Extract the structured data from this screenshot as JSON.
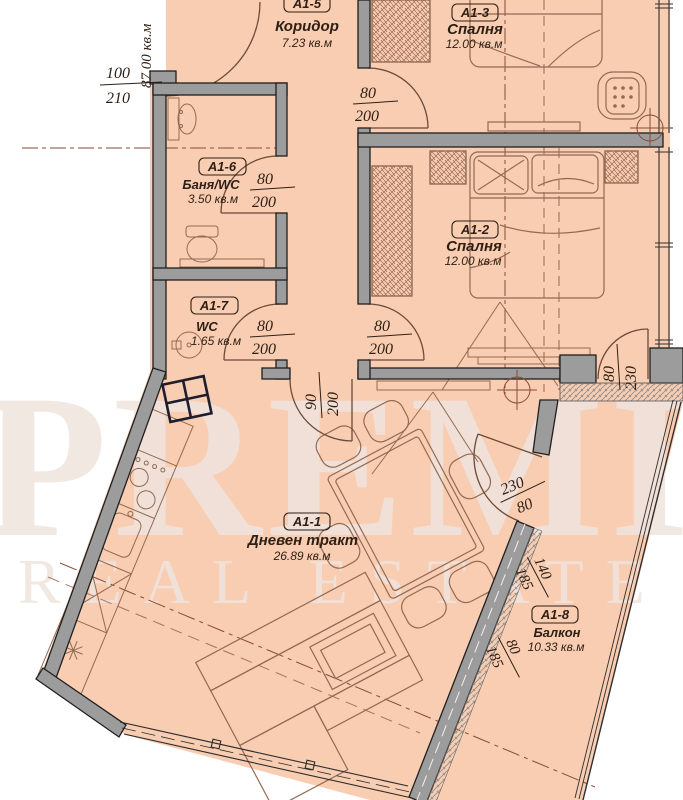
{
  "watermark": {
    "brand": "PREMIER",
    "tagline": "REAL ESTATE"
  },
  "total_area_side_label": "87.00 кв.м",
  "rooms": {
    "corridor": {
      "code": "А1-5",
      "name": "Коридор",
      "area": "7.23 кв.м"
    },
    "bedroom3": {
      "code": "А1-3",
      "name": "Спалня",
      "area": "12.00 кв.м"
    },
    "bathroom": {
      "code": "А1-6",
      "name": "Баня/WC",
      "area": "3.50 кв.м"
    },
    "wc": {
      "code": "А1-7",
      "name": "WC",
      "area": "1.65 кв.м"
    },
    "bedroom2": {
      "code": "А1-2",
      "name": "Спалня",
      "area": "12.00 кв.м"
    },
    "living": {
      "code": "А1-1",
      "name": "Дневен тракт",
      "area": "26.89 кв.м"
    },
    "balcony": {
      "code": "А1-8",
      "name": "Балкон",
      "area": "10.33 кв.м"
    }
  },
  "dims": {
    "entrance": {
      "w": "100",
      "h": "210"
    },
    "bedroom3_door": {
      "w": "80",
      "h": "200"
    },
    "bath_door": {
      "w": "80",
      "h": "200"
    },
    "wc_door": {
      "w": "80",
      "h": "200"
    },
    "bedroom2_door": {
      "w": "80",
      "h": "200"
    },
    "living_door": {
      "w": "90",
      "h": "200"
    },
    "bedroom2_balcony_door": {
      "w": "80",
      "h": "230"
    },
    "balcony_door": {
      "w": "230",
      "h": "80"
    },
    "balcony_window_large": {
      "w": "140",
      "h": "185"
    },
    "balcony_window_small": {
      "w": "80",
      "h": "185"
    }
  },
  "colors": {
    "floor": "#f8cdb2",
    "wall": "#9c9c9c",
    "furniture_line": "#936a52",
    "axis_line": "#8a4a35"
  }
}
